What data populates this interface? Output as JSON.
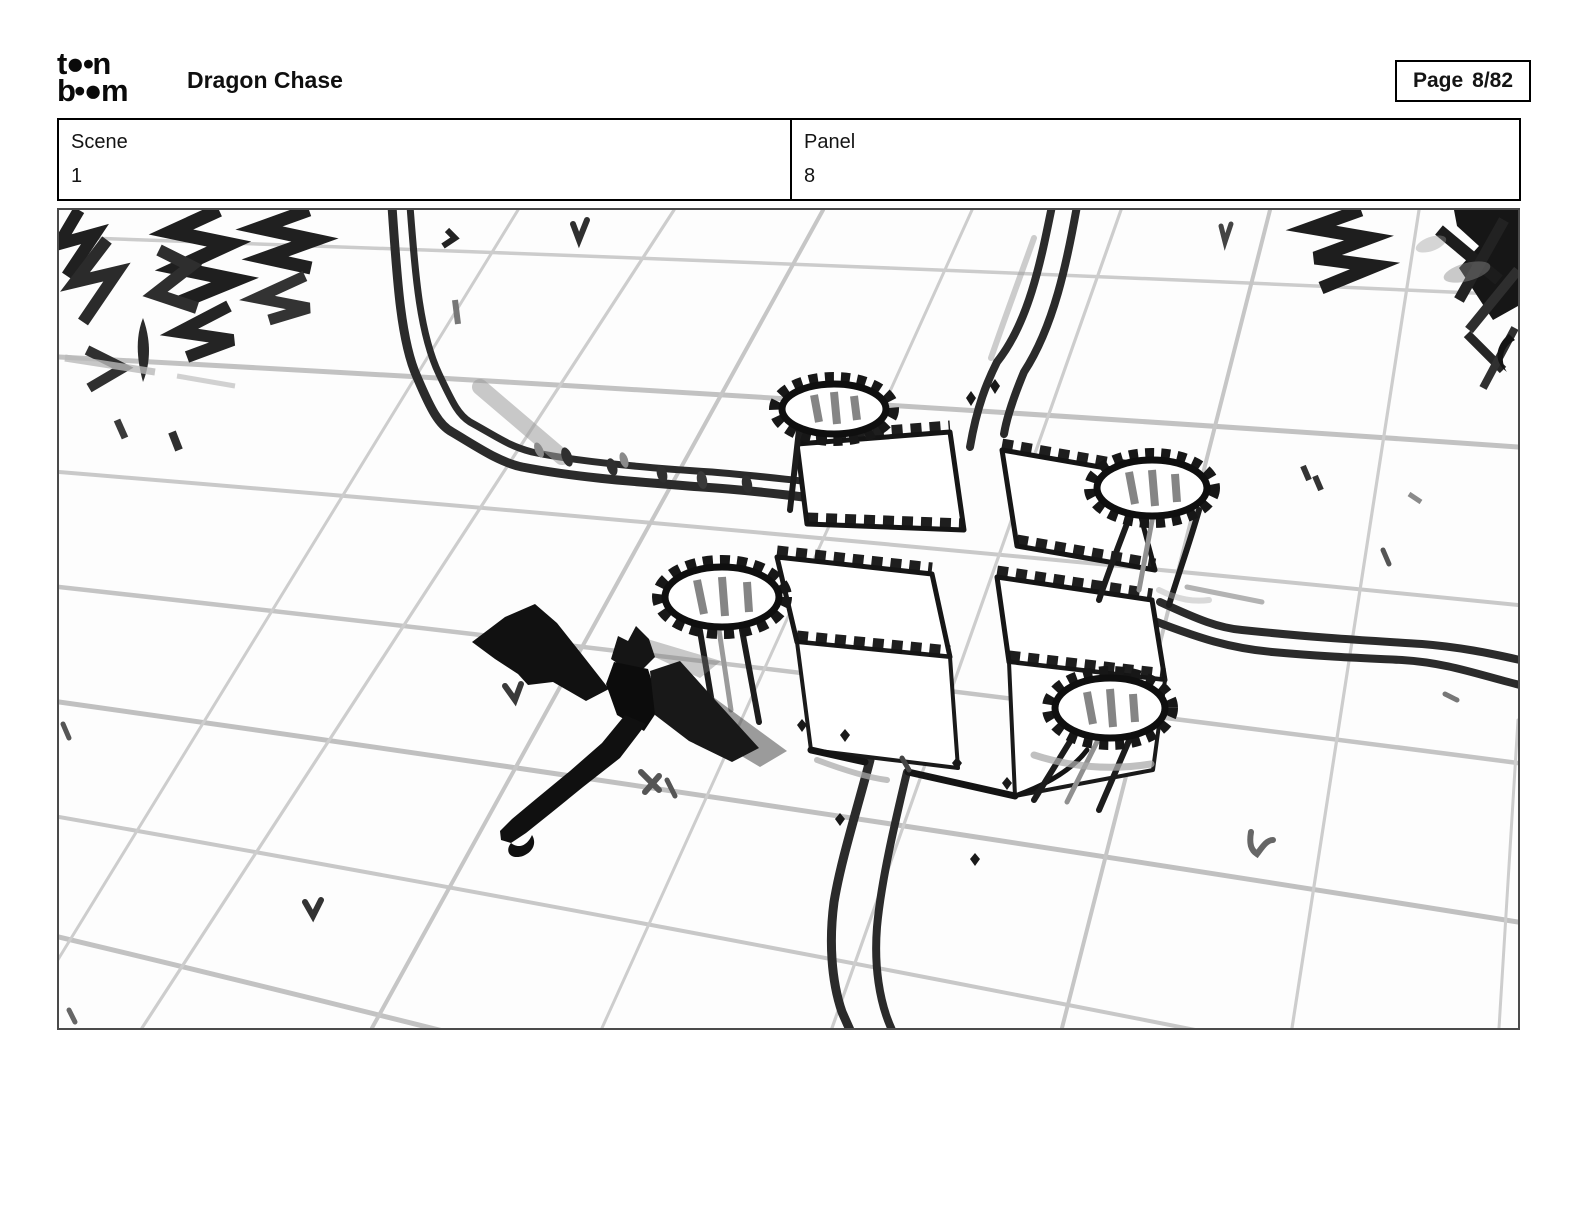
{
  "header": {
    "logo": {
      "line1": "t●•n",
      "line2": "b•●m"
    },
    "title": "Dragon Chase",
    "page": {
      "label": "Page",
      "value": "8/82"
    }
  },
  "info": {
    "scene_label": "Scene",
    "scene_value": "1",
    "panel_label": "Panel",
    "panel_value": "8"
  },
  "colors": {
    "ink": "#141414",
    "grid_line": "#c6c6c6",
    "road": "#2b2b2b",
    "panel_border": "#4a4a4a",
    "background": "#ffffff"
  }
}
